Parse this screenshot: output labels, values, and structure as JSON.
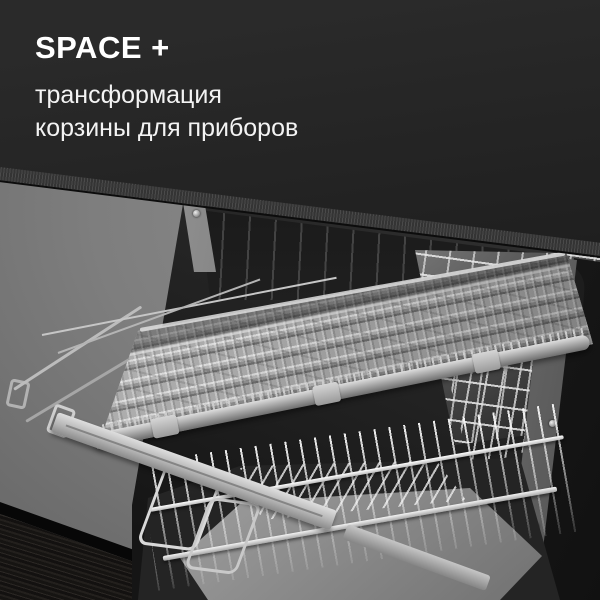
{
  "caption": {
    "title": "SPACE +",
    "subtitle_line1": "трансформация",
    "subtitle_line2": "корзины для приборов"
  },
  "colors": {
    "background": "#262626",
    "text": "#ffffff",
    "countertop": "#161616",
    "countertop_edge": "#3e3e3e",
    "wall": "#7b7b7b",
    "floor_wood": "#1b1816",
    "tray_plastic": "#b5b5b5",
    "metal_wire": "#cfcfcf",
    "cavity_shadow": "#1a1a1a"
  },
  "scene": {
    "subject": "built-in dishwasher with extended sliding third-rack cutlery tray"
  }
}
